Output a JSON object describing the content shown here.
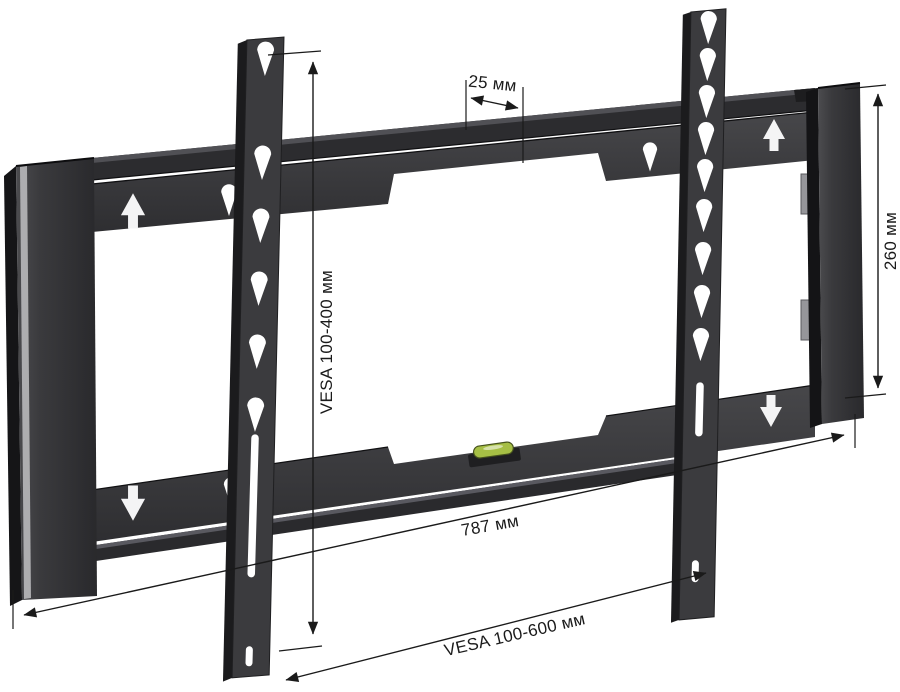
{
  "annotations": {
    "hole_pitch": {
      "label": "25 мм"
    },
    "vesa_vertical": {
      "label": "VESA 100-400 мм"
    },
    "plate_height": {
      "label": "260 мм"
    },
    "plate_width": {
      "label": "787 мм"
    },
    "vesa_horizontal": {
      "label": "VESA 100-600 мм"
    }
  },
  "icons": {
    "up_arrow": "printed white up-arrow on wall plate",
    "down_arrow": "printed white down-arrow on wall plate",
    "teardrop_hole": "teardrop keyhole cutout",
    "bubble_level": "green spirit level vial"
  },
  "colors": {
    "background": "#ffffff",
    "metal_face": "#39393c",
    "metal_dark": "#1b1b1d",
    "highlight": "#c0c0c2",
    "dimension_ink": "#1a1a1a",
    "level_green": "#a6bf45",
    "screw_silver": "#a9a9ab"
  }
}
